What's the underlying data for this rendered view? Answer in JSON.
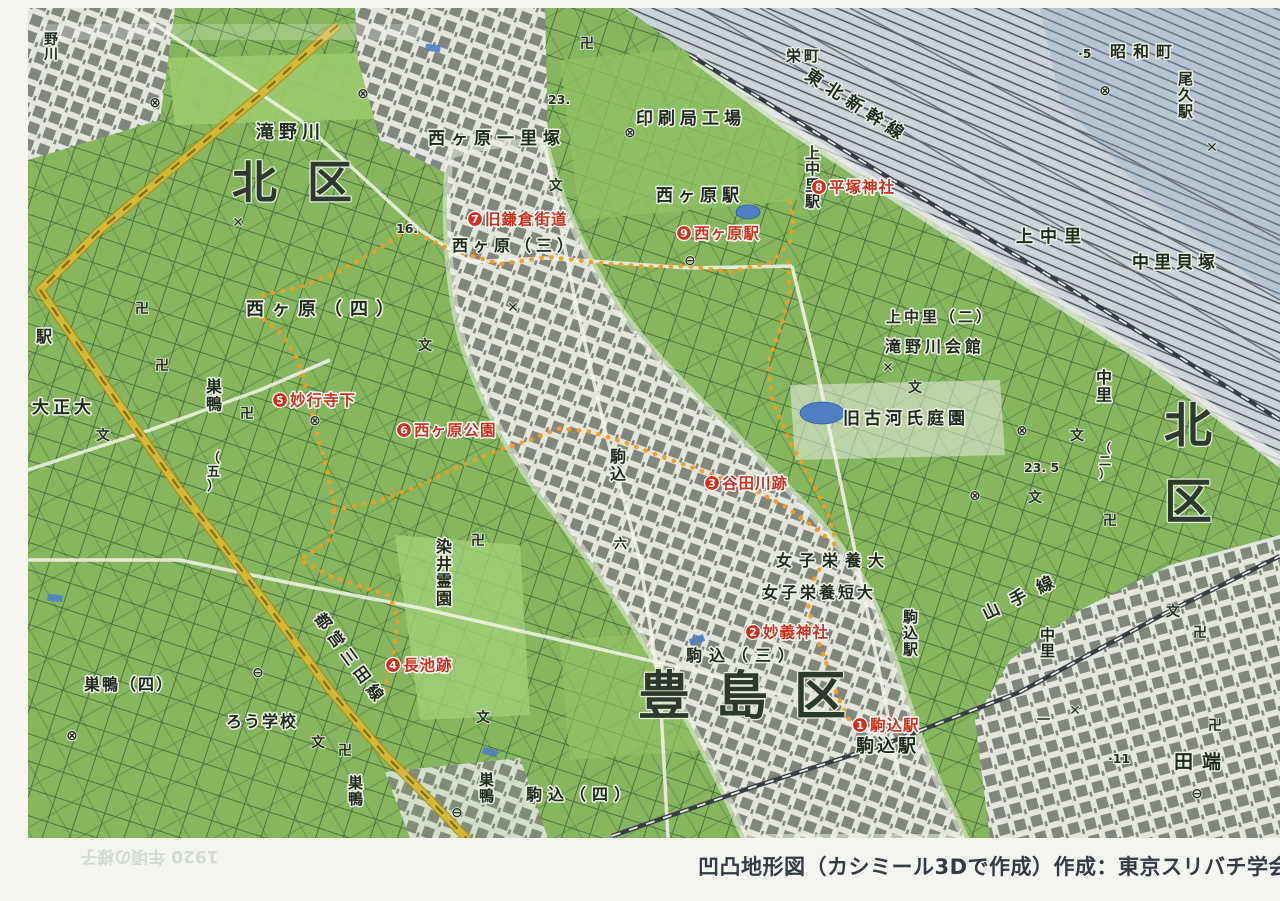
{
  "caption": {
    "text": "凹凸地形図（カシミール3Dで作成）作成：東京スリバチ学会"
  },
  "showthrough": {
    "text": "1920 年頃の様子"
  },
  "colors": {
    "route-orange": "#f49d1a",
    "label-red": "#d3301a",
    "road-yellow": "#d6b832",
    "green-base": "#86b75e",
    "urban-gray": "#81877d",
    "railyard-gray": "#ccd3d9",
    "caption-color": "#343b45"
  },
  "map": {
    "wards": [
      {
        "t": "北区",
        "x": 232,
        "y": 198,
        "fs": 45,
        "ls": 30
      },
      {
        "t": "北区",
        "x": 1164,
        "y": 442,
        "fs": 48,
        "v": 1,
        "dy": 76
      },
      {
        "t": "豊島区",
        "x": 638,
        "y": 714,
        "fs": 52,
        "ls": 26
      }
    ],
    "labels": [
      {
        "t": "滝野川",
        "x": 256,
        "y": 138,
        "fs": 18,
        "ls": 5
      },
      {
        "t": "西ヶ原一里塚",
        "x": 428,
        "y": 144,
        "fs": 17,
        "ls": 6
      },
      {
        "t": "印刷局工場",
        "x": 636,
        "y": 124,
        "fs": 17,
        "ls": 5
      },
      {
        "t": "栄町",
        "x": 786,
        "y": 61,
        "fs": 15,
        "ls": 3
      },
      {
        "t": "昭和町",
        "x": 1110,
        "y": 57,
        "fs": 16,
        "ls": 7
      },
      {
        "t": "東北新幹線",
        "x": 804,
        "y": 78,
        "fs": 17,
        "ls": 7,
        "rot": 33
      },
      {
        "t": "西ヶ原駅",
        "x": 656,
        "y": 201,
        "fs": 17,
        "ls": 5
      },
      {
        "t": "西ヶ原（三）",
        "x": 452,
        "y": 251,
        "fs": 16,
        "ls": 5
      },
      {
        "t": "西ヶ原（四）",
        "x": 246,
        "y": 315,
        "fs": 18,
        "ls": 8
      },
      {
        "t": "駅",
        "x": 36,
        "y": 342,
        "fs": 16
      },
      {
        "t": "大正大",
        "x": 32,
        "y": 413,
        "fs": 17,
        "ls": 4
      },
      {
        "t": "上中里",
        "x": 1016,
        "y": 242,
        "fs": 17,
        "ls": 7
      },
      {
        "t": "中里貝塚",
        "x": 1132,
        "y": 268,
        "fs": 17,
        "ls": 5
      },
      {
        "t": "上中里（二）",
        "x": 886,
        "y": 322,
        "fs": 15,
        "ls": 3
      },
      {
        "t": "滝野川会館",
        "x": 885,
        "y": 352,
        "fs": 16,
        "ls": 4
      },
      {
        "t": "旧古河氏庭園",
        "x": 843,
        "y": 424,
        "fs": 17,
        "ls": 4
      },
      {
        "t": "女子栄養大",
        "x": 776,
        "y": 566,
        "fs": 16,
        "ls": 7
      },
      {
        "t": "女子栄養短大",
        "x": 762,
        "y": 598,
        "fs": 16,
        "ls": 3
      },
      {
        "t": "駒込（三）",
        "x": 686,
        "y": 661,
        "fs": 16,
        "ls": 7
      },
      {
        "t": "駒込駅",
        "x": 856,
        "y": 752,
        "fs": 18,
        "ls": 3
      },
      {
        "t": "駒込（四）",
        "x": 526,
        "y": 800,
        "fs": 16,
        "ls": 6
      },
      {
        "t": "巣鴨（四）",
        "x": 84,
        "y": 690,
        "fs": 16,
        "ls": 2
      },
      {
        "t": "ろう学校",
        "x": 226,
        "y": 727,
        "fs": 16,
        "ls": 2
      },
      {
        "t": "田端",
        "x": 1174,
        "y": 768,
        "fs": 19,
        "ls": 9
      },
      {
        "t": "山手線",
        "x": 986,
        "y": 620,
        "fs": 17,
        "ls": 13,
        "rot": -26
      },
      {
        "t": "都営三田線",
        "x": 314,
        "y": 618,
        "fs": 16,
        "ls": 6,
        "rot": 54
      },
      {
        "t": "上中里駅",
        "x": 805,
        "y": 158,
        "fs": 15,
        "v": 1
      },
      {
        "t": "尾久駅",
        "x": 1178,
        "y": 84,
        "fs": 15,
        "v": 1
      },
      {
        "t": "巣鴨",
        "x": 206,
        "y": 392,
        "fs": 16,
        "v": 1
      },
      {
        "t": "（五）",
        "x": 207,
        "y": 462,
        "fs": 13,
        "v": 1
      },
      {
        "t": "染井霊園",
        "x": 436,
        "y": 552,
        "fs": 16,
        "v": 1
      },
      {
        "t": "巣鴨",
        "x": 348,
        "y": 788,
        "fs": 15,
        "v": 1
      },
      {
        "t": "巣鴨",
        "x": 479,
        "y": 785,
        "fs": 15,
        "v": 1
      },
      {
        "t": "駒込",
        "x": 610,
        "y": 462,
        "fs": 16,
        "v": 1
      },
      {
        "t": "六",
        "x": 614,
        "y": 548,
        "fs": 13,
        "v": 1
      },
      {
        "t": "駒込駅",
        "x": 903,
        "y": 622,
        "fs": 15,
        "v": 1
      },
      {
        "t": "中里",
        "x": 1096,
        "y": 383,
        "fs": 16,
        "v": 1
      },
      {
        "t": "（二）",
        "x": 1099,
        "y": 452,
        "fs": 12,
        "v": 1
      },
      {
        "t": "中里",
        "x": 1040,
        "y": 640,
        "fs": 15,
        "v": 1
      },
      {
        "t": "一",
        "x": 1037,
        "y": 724,
        "fs": 13,
        "v": 1
      },
      {
        "t": "野川",
        "x": 44,
        "y": 44,
        "fs": 14,
        "v": 1
      }
    ],
    "stops": [
      {
        "n": "1",
        "t": "駒込駅",
        "x": 860,
        "y": 725
      },
      {
        "n": "2",
        "t": "妙義神社",
        "x": 753,
        "y": 632
      },
      {
        "n": "3",
        "t": "谷田川跡",
        "x": 712,
        "y": 483
      },
      {
        "n": "4",
        "t": "長池跡",
        "x": 393,
        "y": 665
      },
      {
        "n": "5",
        "t": "妙行寺下",
        "x": 280,
        "y": 400
      },
      {
        "n": "6",
        "t": "西ヶ原公園",
        "x": 404,
        "y": 430
      },
      {
        "n": "7",
        "t": "旧鎌倉街道",
        "x": 475,
        "y": 219
      },
      {
        "n": "8",
        "t": "平塚神社",
        "x": 819,
        "y": 187
      },
      {
        "n": "9",
        "t": "西ヶ原駅",
        "x": 684,
        "y": 233
      }
    ],
    "spots": [
      {
        "t": "23.",
        "x": 548,
        "y": 104
      },
      {
        "t": "16.",
        "x": 396,
        "y": 233
      },
      {
        "t": "23. 5",
        "x": 1024,
        "y": 472
      },
      {
        "t": "·5",
        "x": 1078,
        "y": 58
      },
      {
        "t": "·11",
        "x": 1108,
        "y": 763
      }
    ],
    "symbols": {
      "manji": [
        [
          142,
          313
        ],
        [
          162,
          370
        ],
        [
          247,
          418
        ],
        [
          587,
          48
        ],
        [
          345,
          755
        ],
        [
          478,
          545
        ],
        [
          1110,
          525
        ],
        [
          1200,
          637
        ],
        [
          1215,
          730
        ]
      ],
      "school": [
        [
          425,
          350
        ],
        [
          556,
          190
        ],
        [
          915,
          392
        ],
        [
          1077,
          440
        ],
        [
          1035,
          502
        ],
        [
          483,
          722
        ],
        [
          318,
          747
        ],
        [
          1173,
          616
        ],
        [
          103,
          440
        ]
      ],
      "circle_x": [
        [
          630,
          137
        ],
        [
          315,
          425
        ],
        [
          1022,
          435
        ],
        [
          975,
          500
        ],
        [
          1105,
          95
        ],
        [
          72,
          740
        ],
        [
          155,
          107
        ],
        [
          363,
          98
        ]
      ],
      "station": [
        [
          690,
          265
        ],
        [
          258,
          677
        ],
        [
          457,
          817
        ],
        [
          1197,
          798
        ]
      ],
      "cross": [
        [
          238,
          227
        ],
        [
          513,
          312
        ],
        [
          1212,
          152
        ],
        [
          888,
          372
        ],
        [
          1075,
          715
        ]
      ]
    },
    "ponds": [
      [
        822,
        413,
        22,
        11
      ],
      [
        748,
        212,
        12,
        7
      ]
    ],
    "blue_rects": [
      [
        433,
        48,
        8
      ],
      [
        697,
        640,
        -20
      ],
      [
        55,
        598,
        5
      ],
      [
        490,
        752,
        15
      ]
    ],
    "route": [
      [
        [
          408,
          230
        ],
        [
          452,
          250
        ],
        [
          500,
          264
        ],
        [
          548,
          257
        ],
        [
          600,
          263
        ],
        [
          648,
          267
        ],
        [
          688,
          266
        ],
        [
          730,
          272
        ],
        [
          772,
          262
        ],
        [
          790,
          242
        ],
        [
          793,
          220
        ],
        [
          790,
          200
        ]
      ],
      [
        [
          788,
          262
        ],
        [
          790,
          292
        ],
        [
          780,
          330
        ],
        [
          768,
          362
        ],
        [
          772,
          398
        ],
        [
          788,
          438
        ],
        [
          810,
          478
        ],
        [
          828,
          514
        ],
        [
          836,
          540
        ],
        [
          820,
          568
        ],
        [
          806,
          594
        ],
        [
          812,
          625
        ],
        [
          826,
          662
        ],
        [
          838,
          697
        ],
        [
          852,
          726
        ]
      ],
      [
        [
          408,
          230
        ],
        [
          374,
          252
        ],
        [
          338,
          272
        ],
        [
          300,
          287
        ],
        [
          258,
          296
        ],
        [
          262,
          318
        ],
        [
          282,
          334
        ],
        [
          298,
          360
        ],
        [
          308,
          394
        ],
        [
          316,
          430
        ],
        [
          326,
          466
        ],
        [
          334,
          502
        ],
        [
          332,
          538
        ],
        [
          300,
          560
        ],
        [
          330,
          576
        ],
        [
          360,
          586
        ],
        [
          390,
          596
        ],
        [
          398,
          620
        ],
        [
          394,
          650
        ],
        [
          388,
          672
        ],
        [
          384,
          694
        ]
      ],
      [
        [
          334,
          510
        ],
        [
          376,
          502
        ],
        [
          418,
          486
        ],
        [
          456,
          468
        ],
        [
          494,
          452
        ],
        [
          530,
          440
        ],
        [
          560,
          428
        ],
        [
          592,
          432
        ],
        [
          626,
          443
        ],
        [
          660,
          456
        ],
        [
          694,
          468
        ],
        [
          726,
          480
        ],
        [
          758,
          492
        ],
        [
          788,
          508
        ],
        [
          812,
          526
        ],
        [
          830,
          540
        ]
      ]
    ]
  }
}
